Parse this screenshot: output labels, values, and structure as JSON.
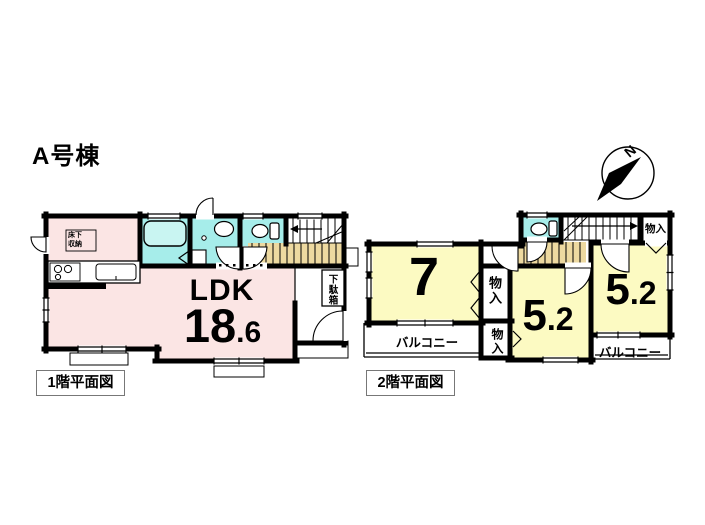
{
  "title": "A号棟",
  "compass": {
    "label": "N"
  },
  "colors": {
    "wall": "#000000",
    "ldk_pink": "#fbe5e4",
    "wet_cyan": "#a6edea",
    "tub_cyan": "#c9f5f2",
    "room_yellow": "#fcfac2",
    "stairs_tan": "#edd9a0"
  },
  "floor1": {
    "caption": "1階平面図",
    "ldk_label": "LDK",
    "ldk_size_main": "18",
    "ldk_size_frac": ".6",
    "under_floor_storage": "床下収納",
    "shoe_cabinet": "下駄箱"
  },
  "floor2": {
    "caption": "2階平面図",
    "room7_size": "7",
    "room52_center_main": "5",
    "room52_center_frac": ".2",
    "room52_right_main": "5",
    "room52_right_frac": ".2",
    "closet_top_right": "物入",
    "closet_upper": "物入",
    "closet_lower": "物入",
    "balcony_left": "バルコニー",
    "balcony_right": "バルコニー"
  }
}
